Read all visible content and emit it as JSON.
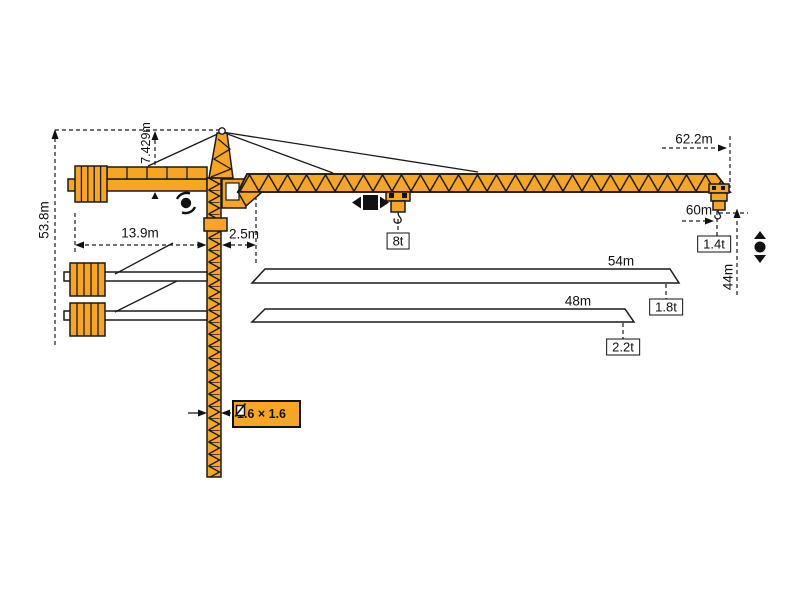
{
  "diagram_type": "tower-crane-working-range-diagram",
  "colors": {
    "crane-orange": "#F6A623",
    "line": "#1a1a1a"
  },
  "labels": {
    "total_height": "53.8m",
    "head_height": "7.429m",
    "counter_jib_length": "13.9m",
    "tail_radius": "2.5m",
    "max_load": "8t",
    "max_radius": "62.2m",
    "radius_60": "60m",
    "tip_load_62": "1.4t",
    "hook_height": "44m",
    "jib54_length": "54m",
    "jib54_tip_load": "1.8t",
    "jib48_length": "48m",
    "jib48_tip_load": "2.2t",
    "mast_section": "1.6 × 1.6"
  },
  "jib_variants": [
    {
      "length": "54m",
      "tip_load": "1.8t"
    },
    {
      "length": "48m",
      "tip_load": "2.2t"
    },
    {
      "length": "62.2m",
      "tip_load": "1.4t"
    }
  ],
  "icons": {
    "slewing": "rotation-icon",
    "trolley": "trolley-travel-icon",
    "hoist": "hoist-up-down-icon",
    "mast_section": "cross-section-icon"
  }
}
